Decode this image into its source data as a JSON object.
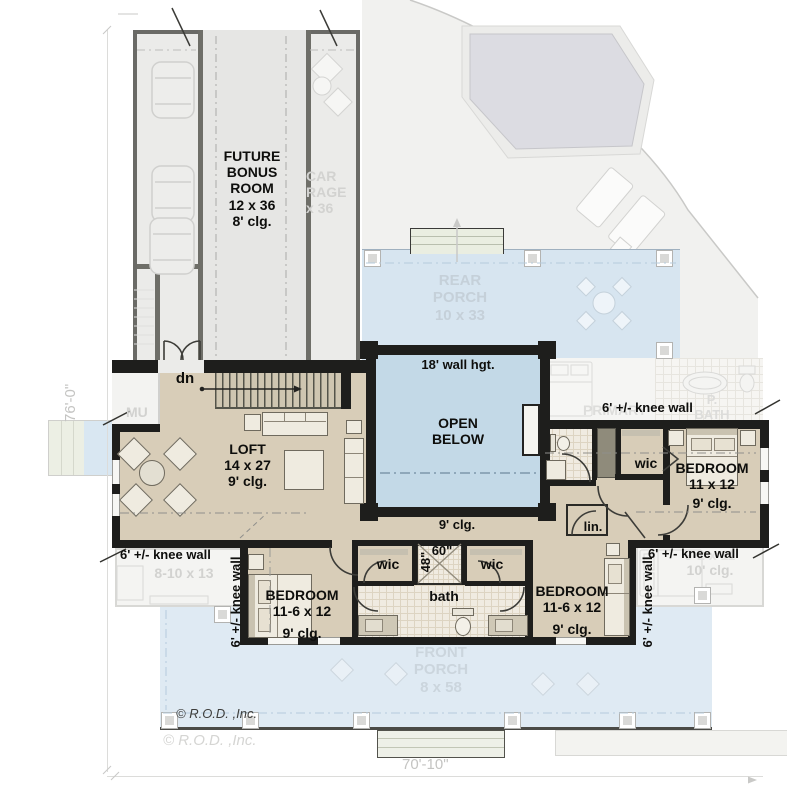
{
  "dimensions": {
    "left_total": "76'-0\"",
    "bottom_total": "70'-10\""
  },
  "copyright": {
    "dark": "© R.O.D. ,Inc.",
    "light": "© R.O.D. ,Inc."
  },
  "labels": {
    "knee_wall": "6' +/- knee wall",
    "stairs_down": "dn",
    "hall_ceiling": "9' clg.",
    "wic": "wic",
    "linen": "lin.",
    "bath": "bath",
    "shower_width": "60\"",
    "shower_depth": "48\""
  },
  "rooms": {
    "future_bonus": {
      "l1": "FUTURE",
      "l2": "BONUS",
      "l3": "ROOM",
      "size": "12 x 36",
      "clg": "8' clg."
    },
    "loft": {
      "name": "LOFT",
      "size": "14 x 27",
      "clg": "9' clg."
    },
    "open_below": {
      "l1": "OPEN",
      "l2": "BELOW",
      "wall": "18' wall hgt."
    },
    "bedroom_e": {
      "name": "BEDROOM",
      "size": "11 x 12",
      "clg": "9' clg."
    },
    "bedroom_sw": {
      "name": "BEDROOM",
      "size": "11-6 x 12",
      "clg": "9' clg."
    },
    "bedroom_se": {
      "name": "BEDROOM",
      "size": "11-6 x 12",
      "clg": "9' clg."
    }
  },
  "ghost": {
    "garage_1": "CAR",
    "garage_2": "RAGE",
    "garage_3": "x 36",
    "rear_porch_1": "REAR",
    "rear_porch_2": "PORCH",
    "rear_porch_3": "10 x 33",
    "front_porch_1": "FRONT",
    "front_porch_2": "PORCH",
    "front_porch_3": "8 x 58",
    "primary": "PRIMARY",
    "pbath_1": "P.",
    "pbath_2": "BATH",
    "room_sw_size": "8-10 x 13",
    "room_se_size": "9-2 x 11",
    "room_se_clg": "10' clg.",
    "mud": "MU"
  },
  "colors": {
    "floor_tan": "#d8cdb8",
    "open_below_blue": "#c3d9e7",
    "front_porch_blue": "#dfeaf3",
    "rear_porch_blue": "#d7e5f0",
    "wall_black": "#1e1e1c",
    "ghost_gray": "#f1f1ef"
  }
}
